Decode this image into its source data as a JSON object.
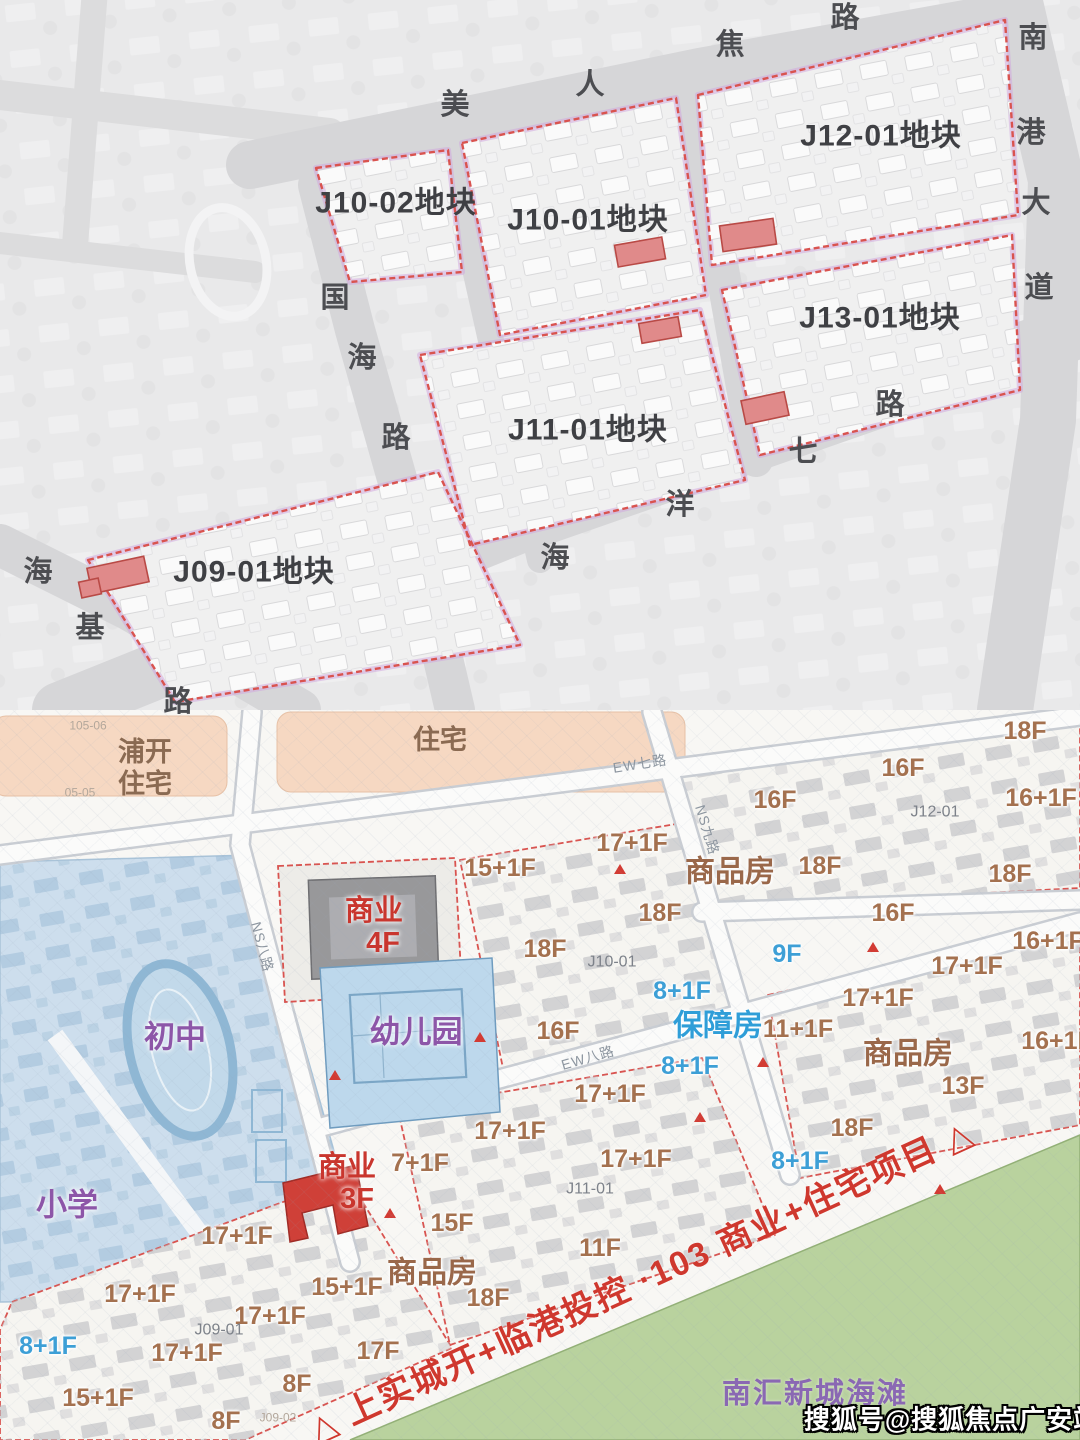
{
  "page": {
    "title": "临港地块规划图"
  },
  "top_map": {
    "plots": [
      {
        "id": "J10-02",
        "label": "J10-02地块",
        "x": 396,
        "y": 203
      },
      {
        "id": "J10-01",
        "label": "J10-01地块",
        "x": 588,
        "y": 220
      },
      {
        "id": "J12-01",
        "label": "J12-01地块",
        "x": 881,
        "y": 136
      },
      {
        "id": "J13-01",
        "label": "J13-01地块",
        "x": 880,
        "y": 318
      },
      {
        "id": "J11-01",
        "label": "J11-01地块",
        "x": 588,
        "y": 430
      },
      {
        "id": "J09-01",
        "label": "J09-01地块",
        "x": 254,
        "y": 572
      }
    ],
    "roads": [
      {
        "name": "美人蕉路",
        "chars": [
          {
            "c": "美",
            "x": 455,
            "y": 105
          },
          {
            "c": "人",
            "x": 590,
            "y": 85
          },
          {
            "c": "焦",
            "x": 730,
            "y": 45
          },
          {
            "c": "路",
            "x": 845,
            "y": 18
          }
        ]
      },
      {
        "name": "南港大道",
        "chars": [
          {
            "c": "南",
            "x": 1033,
            "y": 38
          },
          {
            "c": "港",
            "x": 1031,
            "y": 133
          },
          {
            "c": "大",
            "x": 1036,
            "y": 203
          },
          {
            "c": "道",
            "x": 1039,
            "y": 288
          }
        ]
      },
      {
        "name": "国海路",
        "chars": [
          {
            "c": "国",
            "x": 335,
            "y": 298
          },
          {
            "c": "海",
            "x": 362,
            "y": 358
          },
          {
            "c": "路",
            "x": 396,
            "y": 438
          }
        ]
      },
      {
        "name": "海洋七路",
        "chars": [
          {
            "c": "海",
            "x": 555,
            "y": 558
          },
          {
            "c": "洋",
            "x": 680,
            "y": 505
          },
          {
            "c": "七",
            "x": 803,
            "y": 452
          },
          {
            "c": "路",
            "x": 890,
            "y": 405
          }
        ]
      },
      {
        "name": "海基路",
        "chars": [
          {
            "c": "海",
            "x": 38,
            "y": 572
          },
          {
            "c": "基",
            "x": 90,
            "y": 628
          },
          {
            "c": "路",
            "x": 178,
            "y": 702
          }
        ]
      }
    ]
  },
  "bottom_map": {
    "labels": [
      {
        "t": "浦开",
        "x": 145,
        "y": 752,
        "ty": "beige"
      },
      {
        "t": "住宅",
        "x": 145,
        "y": 784,
        "ty": "beige"
      },
      {
        "t": "住宅",
        "x": 440,
        "y": 740,
        "ty": "beige"
      },
      {
        "t": "105-06",
        "x": 88,
        "y": 726,
        "ty": "tiny"
      },
      {
        "t": "05-05",
        "x": 80,
        "y": 793,
        "ty": "tiny"
      },
      {
        "t": "初中",
        "x": 175,
        "y": 1038,
        "ty": "purple"
      },
      {
        "t": "小学",
        "x": 67,
        "y": 1206,
        "ty": "purple"
      },
      {
        "t": "幼儿园",
        "x": 416,
        "y": 1033,
        "ty": "purple"
      },
      {
        "t": "商业",
        "x": 374,
        "y": 911,
        "ty": "redbiz"
      },
      {
        "t": "4F",
        "x": 383,
        "y": 943,
        "ty": "redbiz"
      },
      {
        "t": "商业",
        "x": 347,
        "y": 1167,
        "ty": "redbiz"
      },
      {
        "t": "3F",
        "x": 357,
        "y": 1199,
        "ty": "redbiz"
      },
      {
        "t": "商品房",
        "x": 730,
        "y": 872,
        "ty": "bigbrown"
      },
      {
        "t": "商品房",
        "x": 908,
        "y": 1054,
        "ty": "bigbrown"
      },
      {
        "t": "商品房",
        "x": 432,
        "y": 1273,
        "ty": "bigbrown"
      },
      {
        "t": "保障房",
        "x": 718,
        "y": 1026,
        "ty": "bigblue"
      },
      {
        "t": "9F",
        "x": 787,
        "y": 954,
        "ty": "fblue"
      },
      {
        "t": "8+1F",
        "x": 682,
        "y": 991,
        "ty": "fblue"
      },
      {
        "t": "8+1F",
        "x": 690,
        "y": 1066,
        "ty": "fblue"
      },
      {
        "t": "8+1F",
        "x": 800,
        "y": 1161,
        "ty": "fblue"
      },
      {
        "t": "8+1F",
        "x": 48,
        "y": 1346,
        "ty": "fblue"
      },
      {
        "t": "18F",
        "x": 1025,
        "y": 731,
        "ty": "floor"
      },
      {
        "t": "16F",
        "x": 903,
        "y": 768,
        "ty": "floor"
      },
      {
        "t": "16F",
        "x": 775,
        "y": 800,
        "ty": "floor"
      },
      {
        "t": "16+1F",
        "x": 1041,
        "y": 798,
        "ty": "floor"
      },
      {
        "t": "15+1F",
        "x": 500,
        "y": 868,
        "ty": "floor"
      },
      {
        "t": "17+1F",
        "x": 632,
        "y": 843,
        "ty": "floor"
      },
      {
        "t": "18F",
        "x": 820,
        "y": 866,
        "ty": "floor"
      },
      {
        "t": "18F",
        "x": 1010,
        "y": 874,
        "ty": "floor"
      },
      {
        "t": "16F",
        "x": 893,
        "y": 913,
        "ty": "floor"
      },
      {
        "t": "18F",
        "x": 660,
        "y": 913,
        "ty": "floor"
      },
      {
        "t": "18F",
        "x": 545,
        "y": 949,
        "ty": "floor"
      },
      {
        "t": "16+1F",
        "x": 1048,
        "y": 941,
        "ty": "floor"
      },
      {
        "t": "17+1F",
        "x": 967,
        "y": 966,
        "ty": "floor"
      },
      {
        "t": "17+1F",
        "x": 878,
        "y": 998,
        "ty": "floor"
      },
      {
        "t": "16F",
        "x": 558,
        "y": 1031,
        "ty": "floor"
      },
      {
        "t": "11+1F",
        "x": 798,
        "y": 1029,
        "ty": "floor"
      },
      {
        "t": "16+1F",
        "x": 1057,
        "y": 1041,
        "ty": "floor"
      },
      {
        "t": "13F",
        "x": 963,
        "y": 1086,
        "ty": "floor"
      },
      {
        "t": "17+1F",
        "x": 610,
        "y": 1094,
        "ty": "floor"
      },
      {
        "t": "18F",
        "x": 852,
        "y": 1128,
        "ty": "floor"
      },
      {
        "t": "17+1F",
        "x": 510,
        "y": 1131,
        "ty": "floor"
      },
      {
        "t": "7+1F",
        "x": 420,
        "y": 1163,
        "ty": "floor"
      },
      {
        "t": "17+1F",
        "x": 636,
        "y": 1159,
        "ty": "floor"
      },
      {
        "t": "15F",
        "x": 452,
        "y": 1223,
        "ty": "floor"
      },
      {
        "t": "11F",
        "x": 600,
        "y": 1248,
        "ty": "floor"
      },
      {
        "t": "15+1F",
        "x": 347,
        "y": 1287,
        "ty": "floor"
      },
      {
        "t": "18F",
        "x": 488,
        "y": 1298,
        "ty": "floor"
      },
      {
        "t": "17+1F",
        "x": 237,
        "y": 1236,
        "ty": "floor"
      },
      {
        "t": "17+1F",
        "x": 140,
        "y": 1294,
        "ty": "floor"
      },
      {
        "t": "17+1F",
        "x": 270,
        "y": 1316,
        "ty": "floor"
      },
      {
        "t": "17F",
        "x": 378,
        "y": 1351,
        "ty": "floor"
      },
      {
        "t": "15+1F",
        "x": 98,
        "y": 1398,
        "ty": "floor"
      },
      {
        "t": "17+1F",
        "x": 187,
        "y": 1353,
        "ty": "floor"
      },
      {
        "t": "8F",
        "x": 297,
        "y": 1384,
        "ty": "floor"
      },
      {
        "t": "8F",
        "x": 226,
        "y": 1421,
        "ty": "floor"
      },
      {
        "t": "J12-01",
        "x": 935,
        "y": 813,
        "ty": "pid"
      },
      {
        "t": "J10-01",
        "x": 612,
        "y": 963,
        "ty": "pid"
      },
      {
        "t": "J11-01",
        "x": 590,
        "y": 1190,
        "ty": "pid"
      },
      {
        "t": "J09-01",
        "x": 219,
        "y": 1331,
        "ty": "pid"
      },
      {
        "t": "J09-02",
        "x": 278,
        "y": 1418,
        "ty": "tiny"
      },
      {
        "t": "EW七路",
        "x": 640,
        "y": 764,
        "ty": "rsmall",
        "rot": -9
      },
      {
        "t": "NS九路",
        "x": 707,
        "y": 830,
        "ty": "rsmall",
        "rot": 73
      },
      {
        "t": "NS八路",
        "x": 262,
        "y": 947,
        "ty": "rsmall",
        "rot": 75
      },
      {
        "t": "EW八路",
        "x": 588,
        "y": 1058,
        "ty": "rsmall",
        "rot": -16
      },
      {
        "t": "南汇新城海滩",
        "x": 815,
        "y": 1394,
        "ty": "beach"
      },
      {
        "t": "△ 上实城开+临港投控 ·103 商业+住宅项目 △",
        "x": 642,
        "y": 1282,
        "ty": "banner",
        "rot": -24.5
      },
      {
        "t": "搜狐号@搜狐焦点广安站",
        "x": 952,
        "y": 1420,
        "ty": "wm"
      }
    ]
  },
  "colors": {
    "plot_outline_red": "#d9534f",
    "plot_outline_purple": "#c9a0dc",
    "red_building": "#e08a8a",
    "banner_red": "#cf382e",
    "beige_zone": "#f6d8c2",
    "school_blue": "#cddeed",
    "beach_green": "#b9d29e",
    "floor_brown": "#a4714f",
    "floor_blue": "#3d9fd6"
  }
}
